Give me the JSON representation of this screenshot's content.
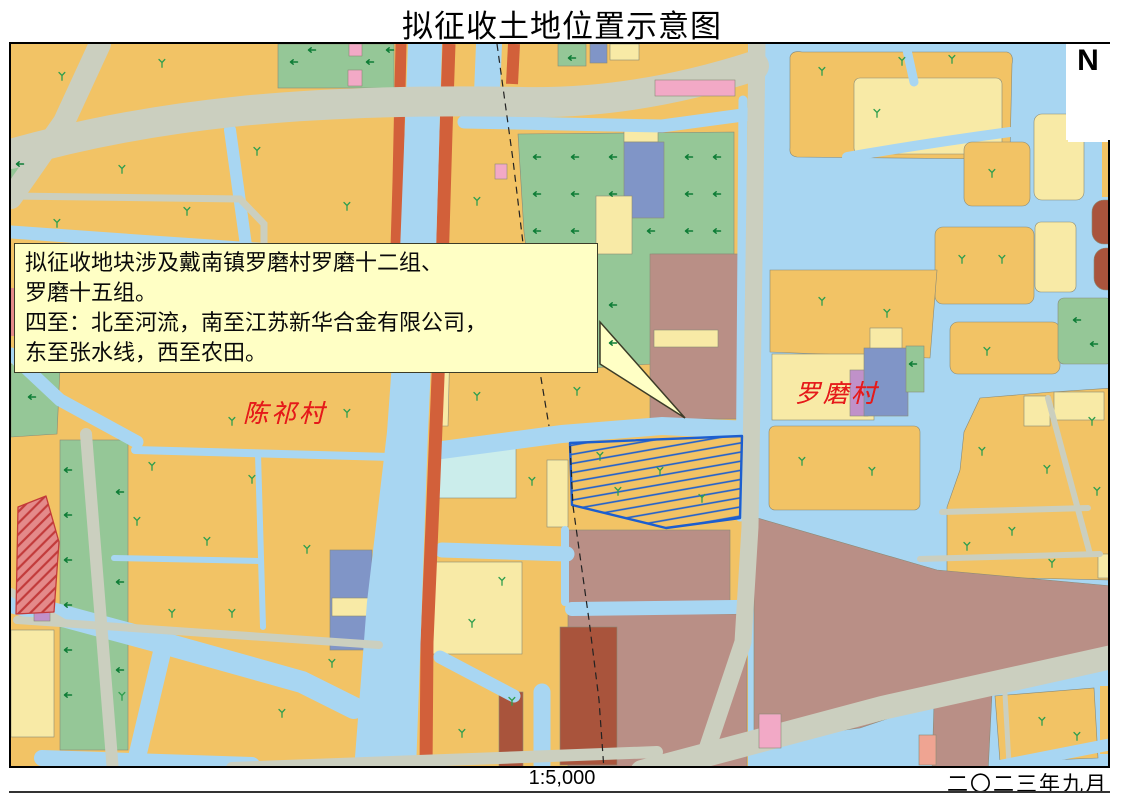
{
  "title": "拟征收土地位置示意图",
  "map": {
    "callout": {
      "lines": [
        "拟征收地块涉及戴南镇罗磨村罗磨十二组、",
        "罗磨十五组。",
        "四至：北至河流，南至江苏新华合金有限公司，",
        "东至张水线，西至农田。"
      ]
    },
    "labels": {
      "village_left": "陈祁村",
      "village_right": "罗磨村",
      "north": "N"
    },
    "symbols": {
      "tree_marker": "farmland-tree-icon",
      "arrow_marker": "orchard-arrow-icon",
      "north_marker": "north-arrow-icon"
    }
  },
  "footer": {
    "scale": "1:5,000",
    "date": "二〇二三年九月"
  },
  "colors": {
    "farm": "#F2C365",
    "py": "#F8EAA6",
    "green": "#95C797",
    "water": "#A8D6F2",
    "road": "#CBCFBF",
    "verm": "#D2603A",
    "brown": "#B98F86",
    "dbrown": "#A9543C",
    "slate": "#8095C7",
    "pink": "#F2A9C6",
    "salmon": "#EFA492",
    "cyan": "#CBEDEB",
    "purple": "#C091C9",
    "red": "#E48A8A",
    "redline": "#C23A3A",
    "hatch": "#1C5ECF",
    "callout": "#FFFFC5",
    "label": "#E51A1A",
    "tree": "#2F9E4E",
    "arrow": "#0E7D36"
  }
}
